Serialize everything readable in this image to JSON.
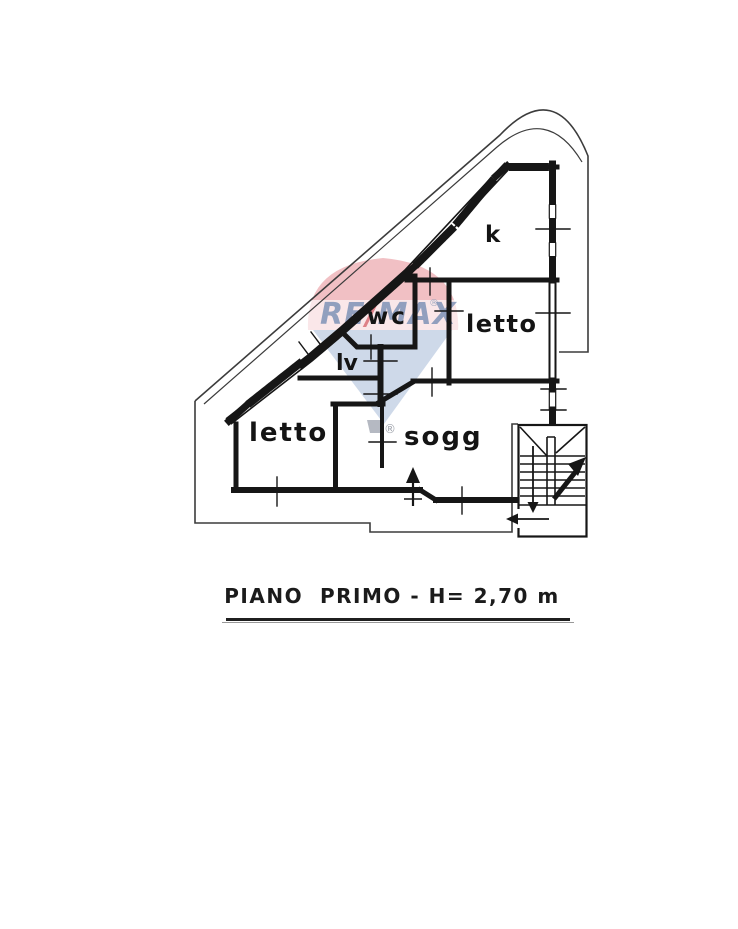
{
  "page": {
    "background": "#ffffff"
  },
  "plan": {
    "line_color": "#161616",
    "rooms": [
      {
        "id": "kitchen",
        "label": "k"
      },
      {
        "id": "bedroom-right",
        "label": "letto"
      },
      {
        "id": "wc",
        "label": "wc"
      },
      {
        "id": "laundry",
        "label": "lv"
      },
      {
        "id": "bedroom-left",
        "label": "letto"
      },
      {
        "id": "living-room",
        "label": "sogg"
      }
    ]
  },
  "caption": {
    "text": "PIANO  PRIMO - H= 2,70 m"
  },
  "watermark": {
    "brand_left": "RE",
    "brand_slash": "/",
    "brand_right": "MAX",
    "registered": "®",
    "red": "#d6404a",
    "blue": "#8aa0c4"
  }
}
